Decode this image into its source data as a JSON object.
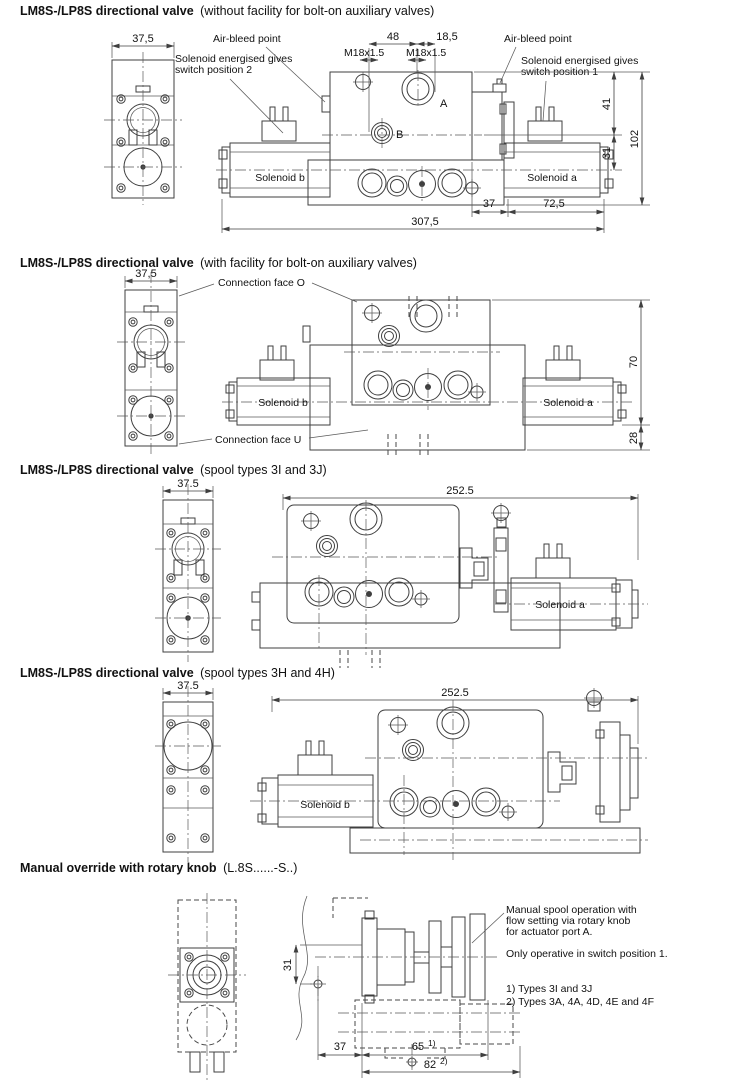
{
  "page": {
    "background": "#ffffff",
    "line_color": "#3f3f3f",
    "text_color": "#111111"
  },
  "sections": [
    {
      "title_bold": "LM8S-/LP8S directional valve",
      "title_note": "(without facility for bolt-on auxiliary valves)",
      "labels": {
        "air_bleed_left": "Air-bleed point",
        "air_bleed_right": "Air-bleed point",
        "energised_2a": "Solenoid energised gives",
        "energised_2b": "switch position 2",
        "energised_1a": "Solenoid energised gives",
        "energised_1b": "switch position 1",
        "solenoid_b": "Solenoid b",
        "solenoid_a": "Solenoid a",
        "port_b": "B",
        "port_a": "A",
        "thread_b": "M18x1.5",
        "thread_a": "M18x1.5"
      },
      "dims": {
        "end_width": "37,5",
        "span_48": "48",
        "span_18_5": "18,5",
        "h_41": "41",
        "h_31": "31",
        "h_102": "102",
        "w_37": "37",
        "w_72_5": "72,5",
        "w_total": "307,5"
      }
    },
    {
      "title_bold": "LM8S-/LP8S directional valve",
      "title_note": "(with facility for bolt-on auxiliary valves)",
      "labels": {
        "conn_o": "Connection face O",
        "conn_u": "Connection face U",
        "solenoid_b": "Solenoid b",
        "solenoid_a": "Solenoid a"
      },
      "dims": {
        "end_width": "37,5",
        "h_70": "70",
        "h_28": "28"
      }
    },
    {
      "title_bold": "LM8S-/LP8S directional valve",
      "title_note": "(spool types 3I and 3J)",
      "labels": {
        "solenoid_a": "Solenoid a"
      },
      "dims": {
        "end_width": "37.5",
        "w_total": "252.5"
      }
    },
    {
      "title_bold": "LM8S-/LP8S directional valve",
      "title_note": "(spool types 3H and 4H)",
      "labels": {
        "solenoid_b": "Solenoid b"
      },
      "dims": {
        "end_width": "37.5",
        "w_total": "252.5"
      }
    },
    {
      "title_bold": "Manual override with rotary knob",
      "title_note": "(L.8S......-S..)",
      "notes": {
        "op1": "Manual spool operation with",
        "op2": "flow setting via rotary knob",
        "op3": "for actuator port A.",
        "op4": "Only operative in switch position 1.",
        "fn1": "1) Types 3I and 3J",
        "fn2": "2) Types 3A, 4A, 4D, 4E and 4F"
      },
      "dims": {
        "h_31": "31",
        "w_37": "37",
        "w_65": "65",
        "w_65_ref": "1)",
        "w_82": "82",
        "w_82_ref": "2)"
      }
    }
  ]
}
